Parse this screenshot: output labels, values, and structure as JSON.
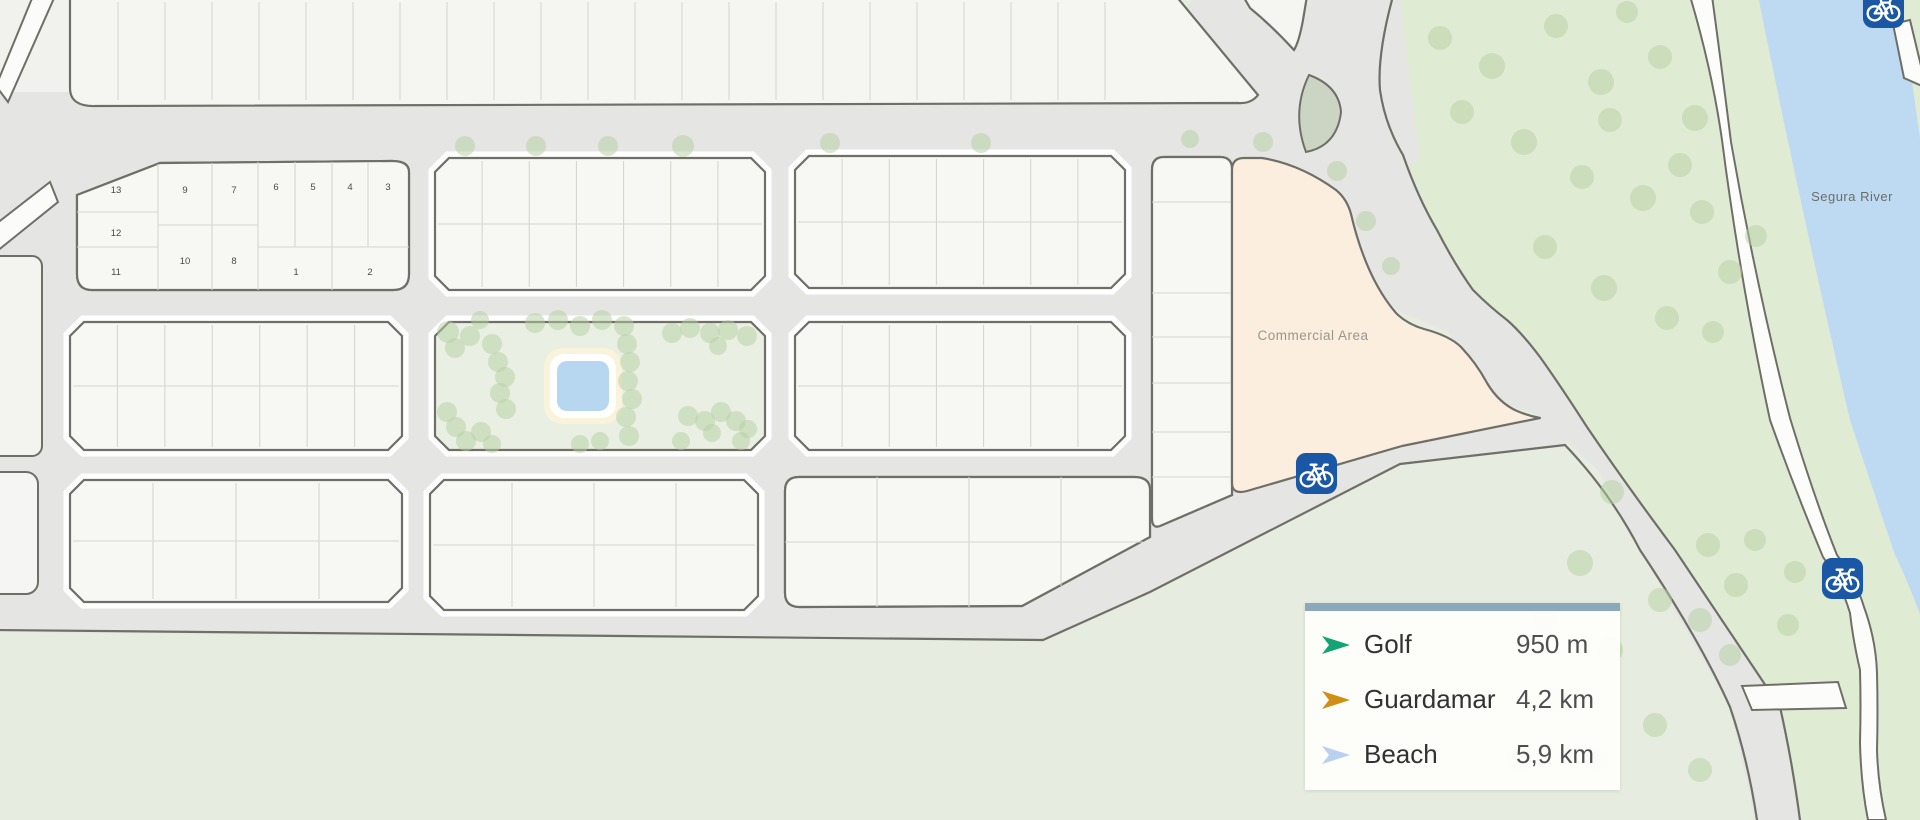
{
  "map_labels": {
    "commercial_area": "Commercial Area",
    "river": "Segura River"
  },
  "plot_numbers": [
    {
      "n": "13",
      "x": 116,
      "y": 190
    },
    {
      "n": "12",
      "x": 116,
      "y": 233
    },
    {
      "n": "11",
      "x": 116,
      "y": 272
    },
    {
      "n": "9",
      "x": 185,
      "y": 190
    },
    {
      "n": "10",
      "x": 185,
      "y": 261
    },
    {
      "n": "7",
      "x": 234,
      "y": 190
    },
    {
      "n": "8",
      "x": 234,
      "y": 261
    },
    {
      "n": "6",
      "x": 276,
      "y": 187
    },
    {
      "n": "5",
      "x": 313,
      "y": 187
    },
    {
      "n": "4",
      "x": 350,
      "y": 187
    },
    {
      "n": "3",
      "x": 388,
      "y": 187
    },
    {
      "n": "1",
      "x": 296,
      "y": 272
    },
    {
      "n": "2",
      "x": 370,
      "y": 272
    }
  ],
  "legend": {
    "items": [
      {
        "label": "Golf",
        "value": "950 m",
        "color": "#16a374"
      },
      {
        "label": "Guardamar",
        "value": "4,2 km",
        "color": "#cf8f13"
      },
      {
        "label": "Beach",
        "value": "5,9 km",
        "color": "#b9d0ee"
      }
    ]
  },
  "colors": {
    "legend_bar": "#8ca9bb",
    "commercial_fill": "#fbeede",
    "river_fill": "#bedaf3",
    "bicycle_sign_blue": "#1a57a5"
  }
}
